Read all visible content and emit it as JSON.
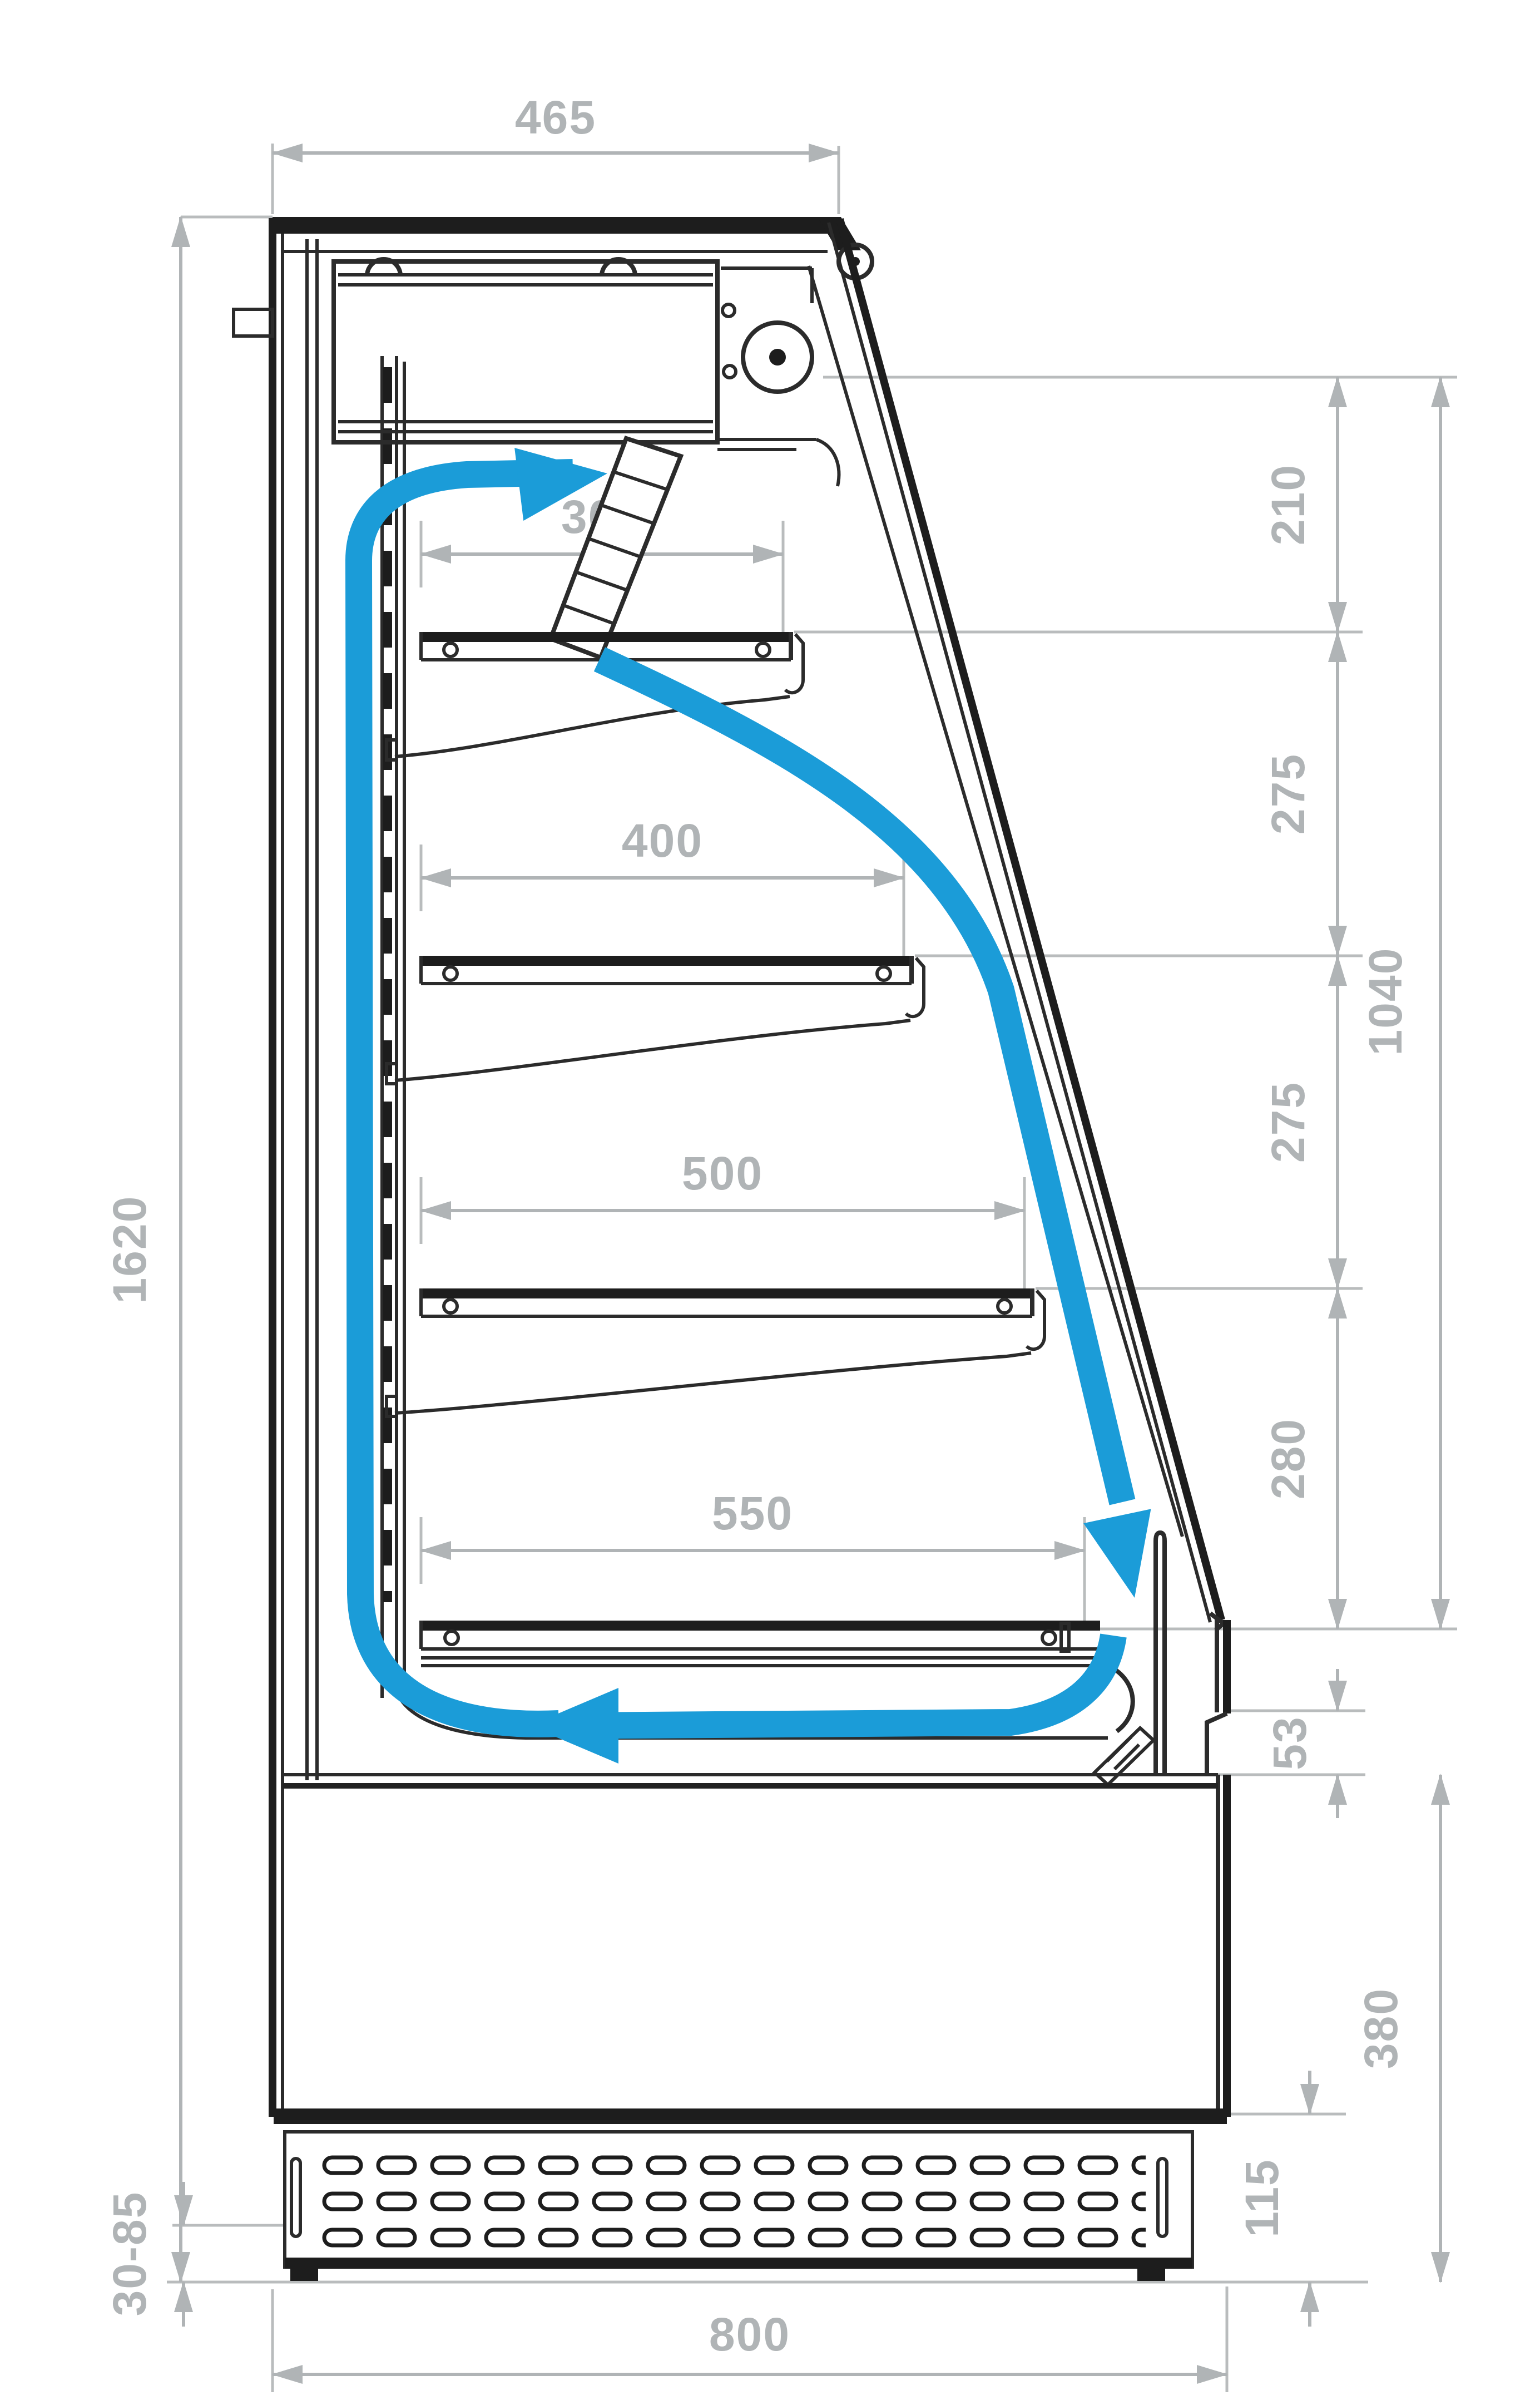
{
  "title": "Open refrigerated display case - side cross-section with air circulation",
  "units": "mm",
  "colors": {
    "airflow_blue": "#1b9cd8",
    "dimension_gray": "#b0b4b6",
    "drawing_black": "#1d1d1d",
    "background": "#ffffff"
  },
  "dimensions": {
    "top_depth": "465",
    "canopy_to_shelf1": "210",
    "shelf1_to_shelf2": "275",
    "shelf2_to_shelf3": "275",
    "shelf3_to_deck": "280",
    "opening_height": "1040",
    "shelf1_depth": "300",
    "shelf2_depth": "400",
    "shelf3_depth": "500",
    "deck_depth": "550",
    "overall_height": "1620",
    "sill_step": "53",
    "base_height": "380",
    "grille_height": "115",
    "feet_range": "30-85",
    "overall_depth": "800"
  },
  "airflow": {
    "loop": [
      "up-back-duct",
      "into-canopy-fan",
      "down-air-curtain-along-glass",
      "return-under-deck"
    ]
  }
}
